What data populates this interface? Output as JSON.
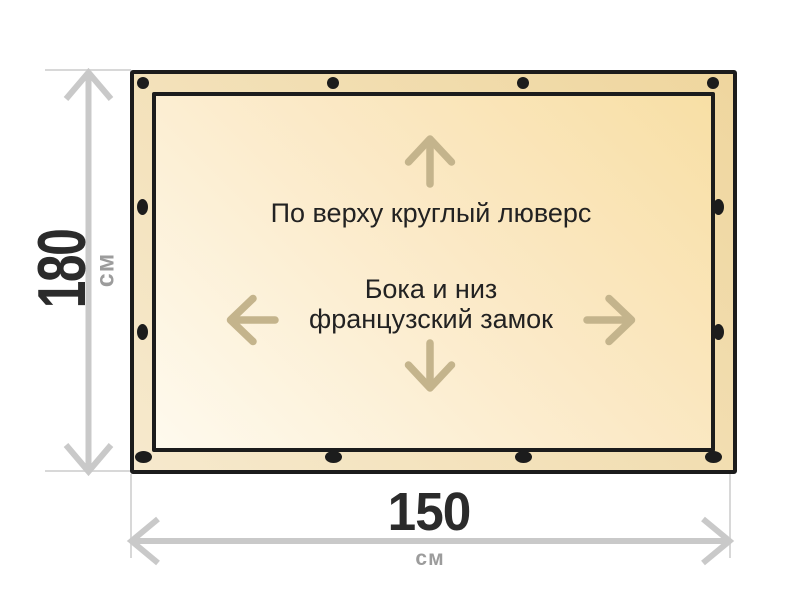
{
  "diagram": {
    "height_dimension": {
      "value": "180",
      "unit": "см"
    },
    "width_dimension": {
      "value": "150",
      "unit": "см"
    },
    "top_note": "По верху круглый люверс",
    "center_note_line1": "Бока и низ",
    "center_note_line2": "французский замок",
    "grommets": {
      "top": 4,
      "bottom": 4,
      "left": 2,
      "right": 2
    },
    "icons": {
      "up-arrow": "↑",
      "down-arrow": "↓",
      "left-arrow": "←",
      "right-arrow": "→",
      "height-dimension-arrow": "↕",
      "width-dimension-arrow": "↔"
    }
  },
  "colors": {
    "ink": "#1c1c1c",
    "text": "#222222",
    "number": "#2b2b2b",
    "unit": "#9c9c9c",
    "dim_line": "#c9c9c9",
    "ext_line": "#d8d8d8",
    "arrow": "#c4b48c",
    "band_light": "#f6e9cd",
    "band_dark": "#efd69e",
    "fill_light": "#fefaee",
    "fill_mid": "#fbe9c6",
    "fill_dark": "#f8dfa5"
  }
}
